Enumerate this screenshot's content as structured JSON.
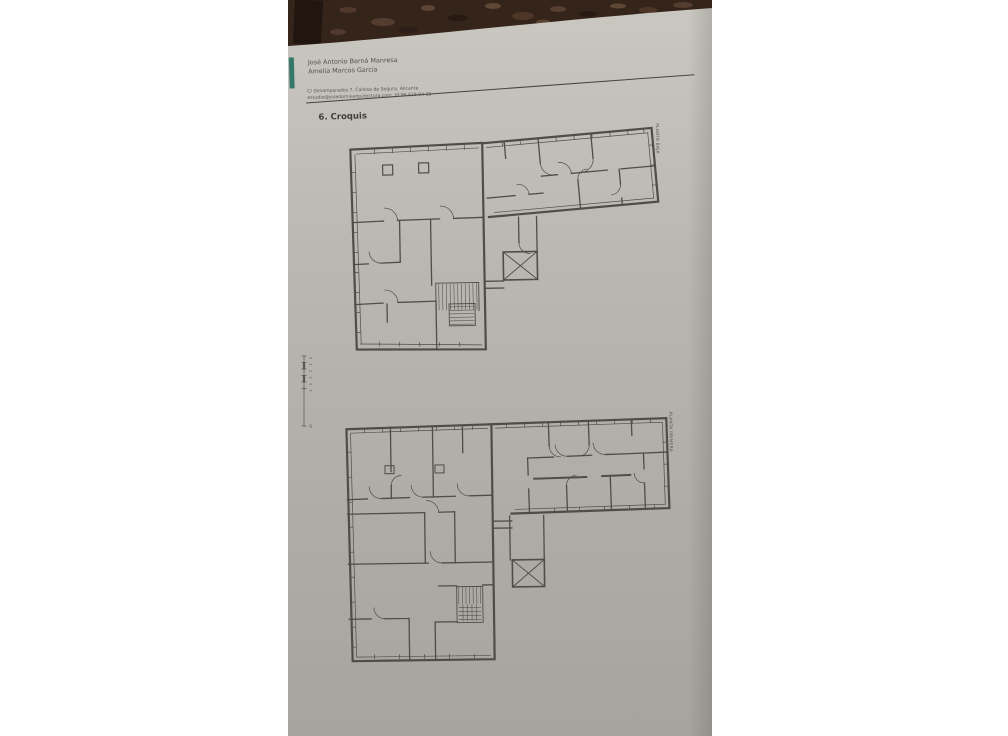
{
  "colors": {
    "page_background": "#ffffff",
    "table_surface_brown": "#35241a",
    "paper_top": "#c9c7c0",
    "paper_bottom": "#a6a49c",
    "accent_bar_teal": "#35786a",
    "ink": "#4c4b45"
  },
  "header": {
    "author_line1": "José Antonio Berná Manresa",
    "author_line2": "Amelia Marcos García",
    "address_line": "C/ Desamparados 7, Callosa de Segura, Alicante",
    "contact_line": "estudio@josedomisarquitectura.com, tlf 96 618 04 35",
    "section_title": "6. Croquis"
  },
  "plans": {
    "upper_label": "PLANTA BAJA",
    "lower_label": "PLANTA PRIMERA"
  },
  "scale_bar": {
    "labels": [
      "0",
      "1",
      "2",
      "3",
      "4",
      "5",
      "10"
    ]
  }
}
